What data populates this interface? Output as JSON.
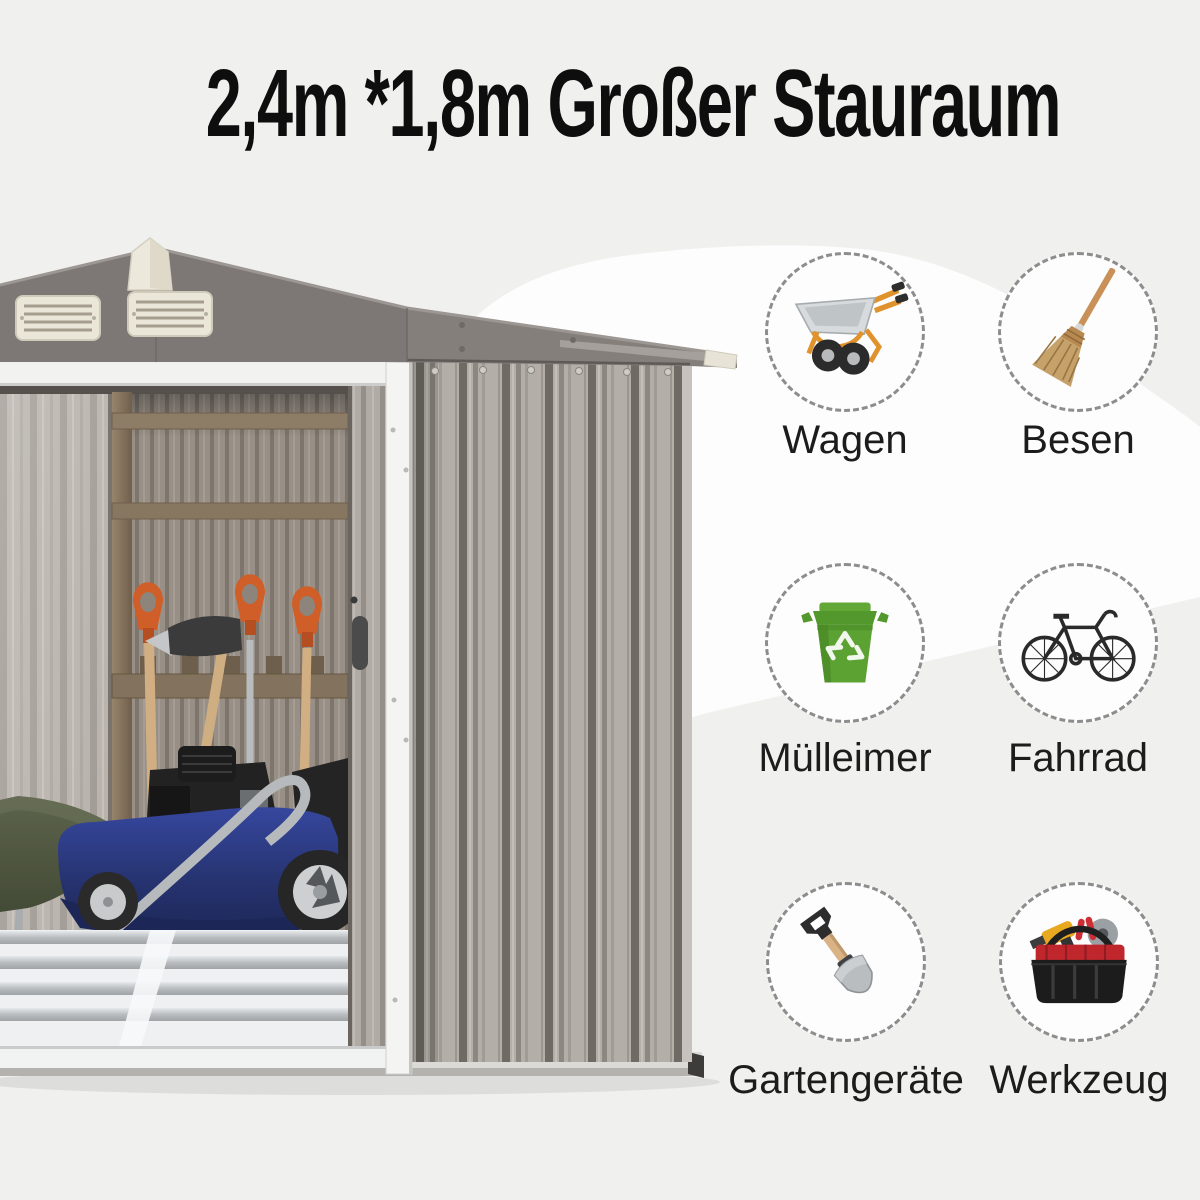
{
  "title": "2,4m *1,8m Großer Stauraum",
  "items": [
    {
      "label": "Wagen",
      "icon": "wheelbarrow-icon"
    },
    {
      "label": "Besen",
      "icon": "broom-icon"
    },
    {
      "label": "Mülleimer",
      "icon": "trash-bin-icon"
    },
    {
      "label": "Fahrrad",
      "icon": "bicycle-icon"
    },
    {
      "label": "Gartengeräte",
      "icon": "shovel-icon"
    },
    {
      "label": "Werkzeug",
      "icon": "toolbag-icon"
    }
  ],
  "colors": {
    "background_gray": "#f0f0ef",
    "background_white_blob": "#fdfdfd",
    "title_text": "#0e0e0e",
    "label_text": "#1c1c1c",
    "circle_dash_border": "#8d8d8d",
    "shed_roof_gray": "#847f7b",
    "shed_wall_taupe": "#b3aea8",
    "shed_trim_cream": "#ece8db",
    "mower_blue": "#2c3a8c",
    "bin_green": "#5ba232",
    "handle_orange": "#cf5e28",
    "frame_orange": "#e0922d"
  }
}
